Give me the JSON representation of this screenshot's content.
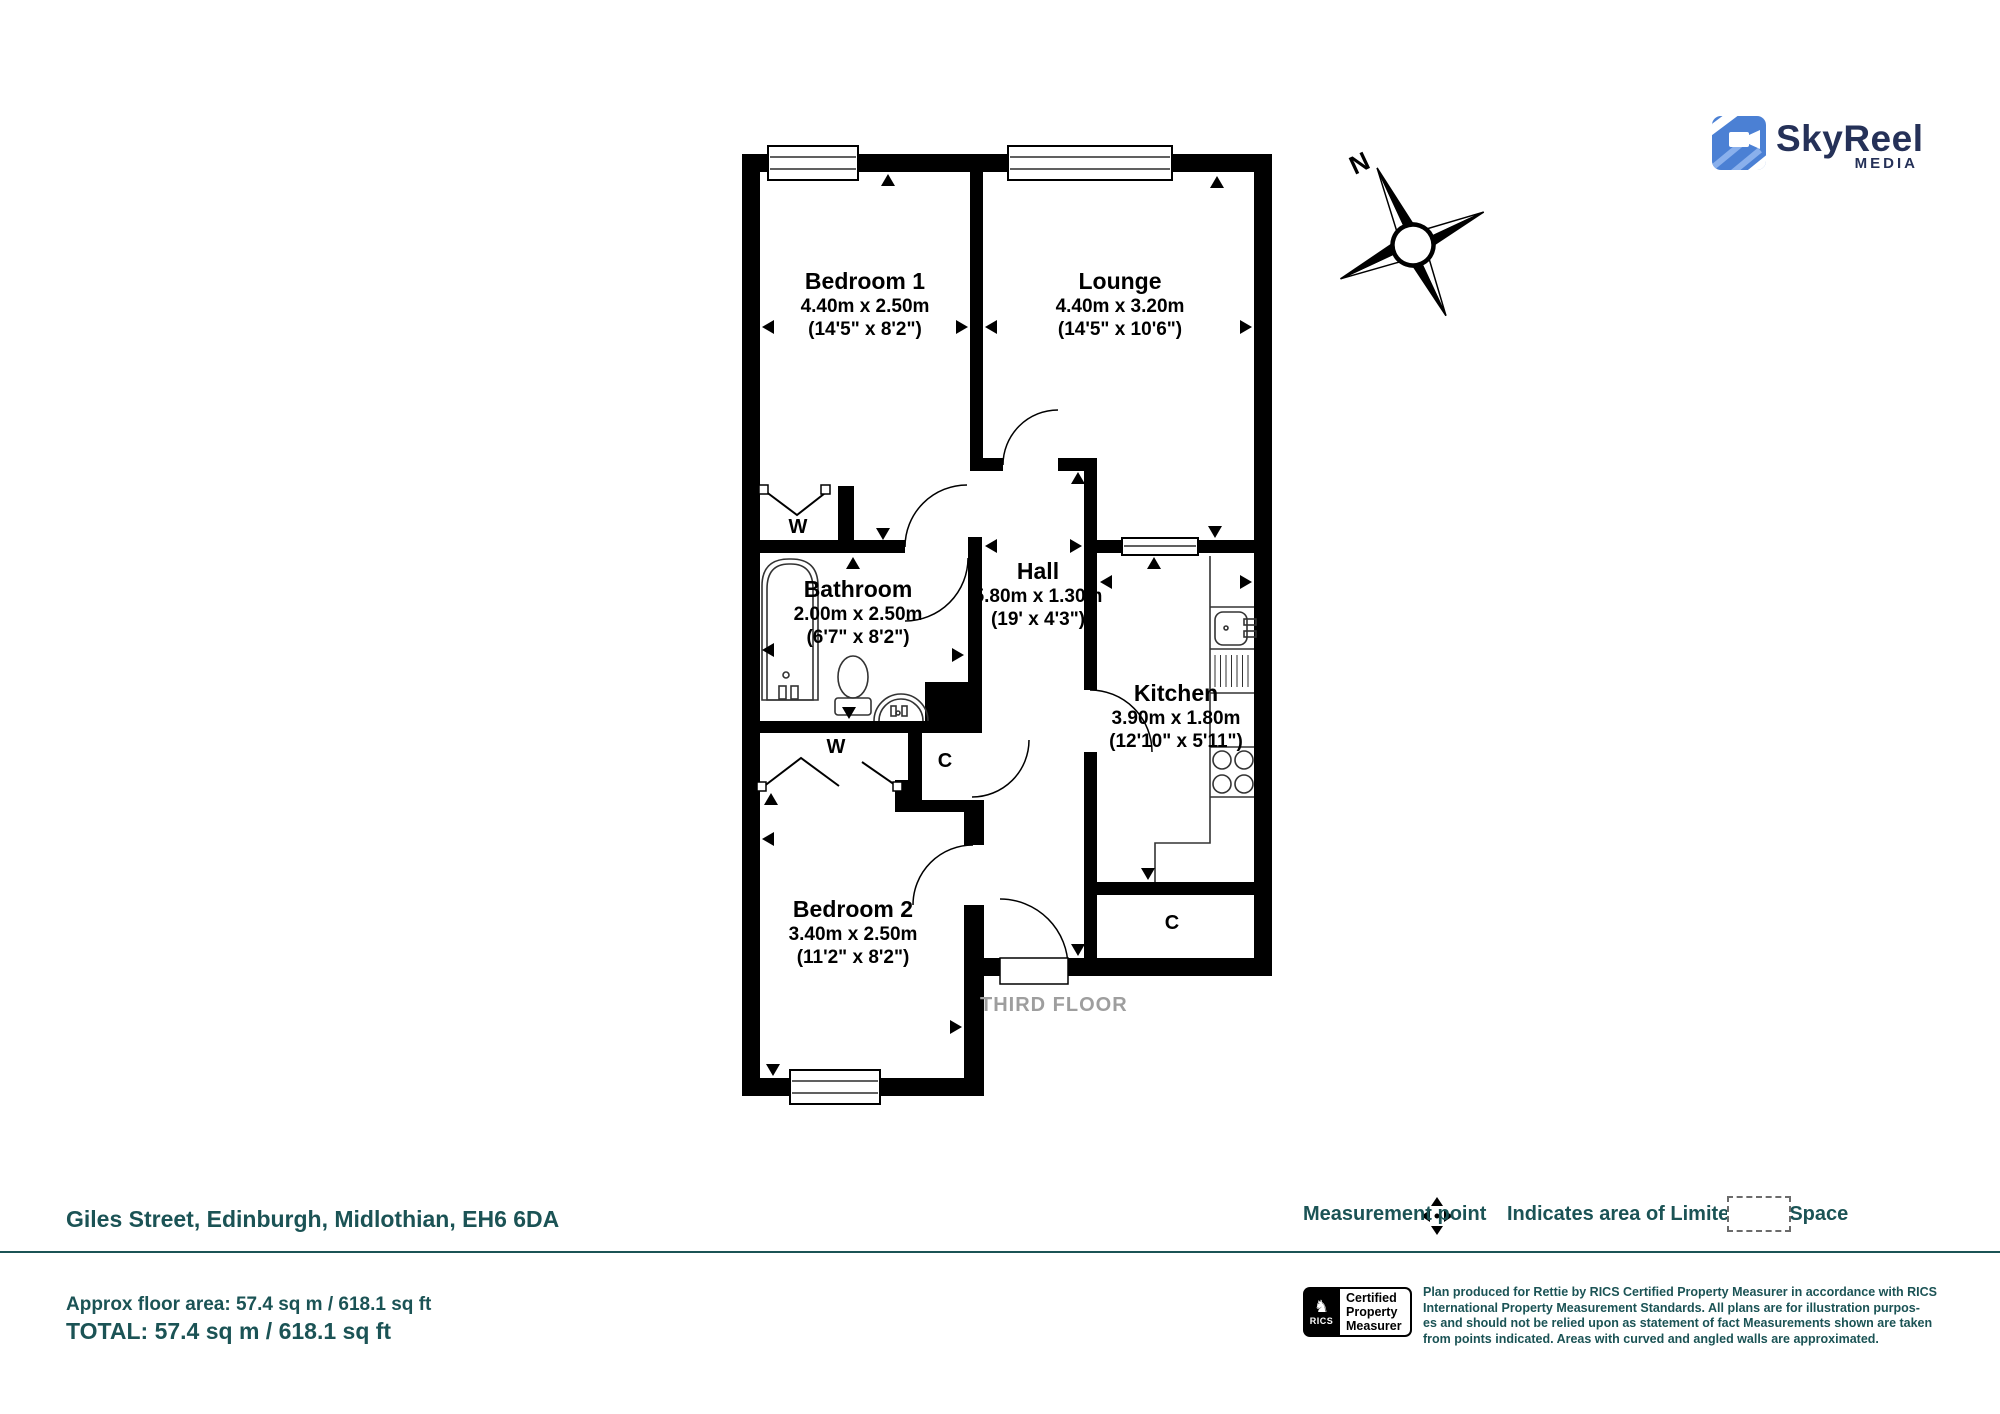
{
  "branding": {
    "name": "SkyReel",
    "tagline": "MEDIA"
  },
  "compass": {
    "north_label": "N"
  },
  "plan": {
    "floor_label": "THIRD FLOOR",
    "rooms": {
      "bedroom1": {
        "name": "Bedroom 1",
        "metric": "4.40m x 2.50m",
        "imperial": "(14'5\" x 8'2\")"
      },
      "lounge": {
        "name": "Lounge",
        "metric": "4.40m x 3.20m",
        "imperial": "(14'5\" x 10'6\")"
      },
      "bathroom": {
        "name": "Bathroom",
        "metric": "2.00m x 2.50m",
        "imperial": "(6'7\" x 8'2\")"
      },
      "hall": {
        "name": "Hall",
        "metric": "5.80m x 1.30m",
        "imperial": "(19' x 4'3\")"
      },
      "kitchen": {
        "name": "Kitchen",
        "metric": "3.90m x 1.80m",
        "imperial": "(12'10\" x 5'11\")"
      },
      "bedroom2": {
        "name": "Bedroom 2",
        "metric": "3.40m x 2.50m",
        "imperial": "(11'2\" x 8'2\")"
      }
    },
    "features": {
      "wardrobe": "W",
      "cupboard": "C"
    }
  },
  "footer": {
    "address": "Giles Street, Edinburgh, Midlothian, EH6 6DA",
    "measurement_point_label": "Measurement point",
    "limited_use_label": "Indicates area of Limited Use Space",
    "approx_area": "Approx floor area: 57.4 sq m / 618.1 sq ft",
    "total_area": "TOTAL: 57.4 sq m / 618.1 sq ft",
    "rics": {
      "org": "RICS",
      "badge_lines": [
        "Certified",
        "Property",
        "Measurer"
      ]
    },
    "disclaimer_lines": [
      "Plan produced for Rettie by RICS Certified Property Measurer in accordance with RICS",
      "International Property Measurement Standards. All plans are for illustration purpos-",
      "es and should not be relied upon as statement of fact Measurements shown are taken",
      "from points indicated. Areas with curved and angled walls are approximated."
    ]
  },
  "colors": {
    "teal": "#1b5355",
    "wall": "#000000",
    "floor_label_gray": "#9e9e9e",
    "brand_navy": "#253158",
    "brand_blue": "#4b80d4"
  }
}
